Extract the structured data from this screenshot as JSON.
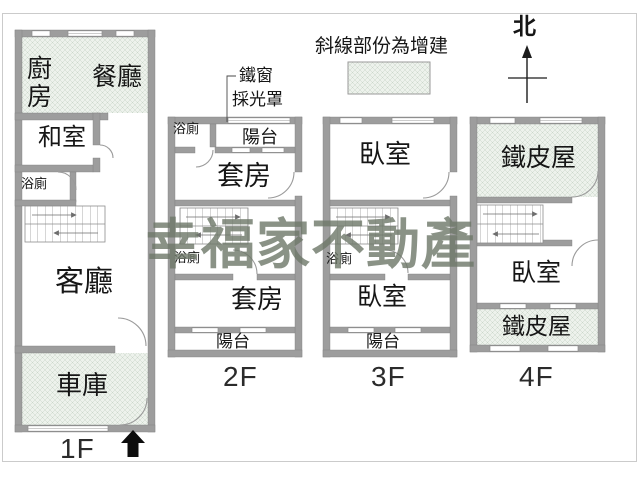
{
  "watermark": {
    "text": "幸福家不動產"
  },
  "compass": {
    "label": "北"
  },
  "legend": {
    "note": "斜線部份為增建"
  },
  "callout": {
    "line1": "鐵窗",
    "line2": "採光罩"
  },
  "floor1": {
    "label": "1F",
    "kitchen": "廚房",
    "dining": "餐廳",
    "tatami": "和室",
    "bath": "浴廁",
    "living": "客廳",
    "garage": "車庫"
  },
  "floor2": {
    "label": "2F",
    "bath_top": "浴廁",
    "balcony_top": "陽台",
    "suite_top": "套房",
    "bath_mid": "浴廁",
    "suite_bottom": "套房",
    "balcony_bottom": "陽台"
  },
  "floor3": {
    "label": "3F",
    "bedroom_top": "臥室",
    "bath": "浴廁",
    "bedroom_bottom": "臥室",
    "balcony": "陽台"
  },
  "floor4": {
    "label": "4F",
    "shed_top": "鐵皮屋",
    "bedroom": "臥室",
    "shed_bottom": "鐵皮屋"
  },
  "colors": {
    "wall": "#9d9d9d",
    "hatch_fill": "#edf2ec",
    "hatch_line": "#c6d4c6",
    "watermark": "#6e7869",
    "annotation": "#1c1c1c",
    "frame": "#cbcbcb"
  }
}
